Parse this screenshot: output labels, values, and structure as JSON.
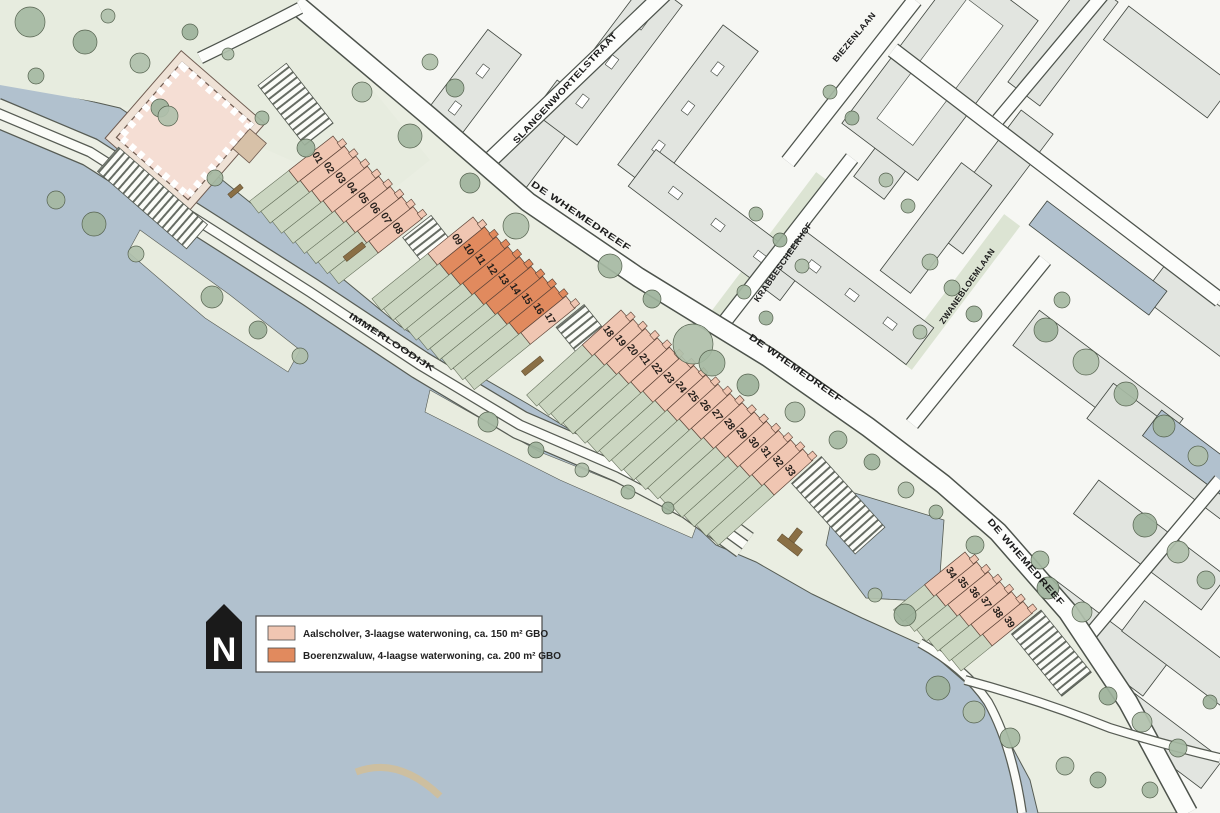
{
  "streets": {
    "slangenwortelstraat": "SLANGENWORTELSTRAAT",
    "de_whemedreef": "DE WHEMEDREEF",
    "immerloodijk": "IMMERLOODIJK",
    "biezenlaan": "BIEZENLAAN",
    "krabbescheerhof": "KRABBESCHEERHOF",
    "zwanebloemlaan": "ZWANEBLOEMLAAN"
  },
  "legend": {
    "items": [
      {
        "key": "aalscholver",
        "color": "#f0c6b2",
        "label": "Aalscholver, 3-laagse waterwoning, ca. 150 m² GBO"
      },
      {
        "key": "boerenzwaluw",
        "color": "#e18a5e",
        "label": "Boerenzwaluw, 4-laagse waterwoning, ca. 200 m² GBO"
      }
    ]
  },
  "compass": {
    "label": "N"
  },
  "plot_types": {
    "aalscholver": "#f0c6b2",
    "boerenzwaluw": "#e18a5e"
  },
  "plots": [
    {
      "number": "01",
      "type": "aalscholver"
    },
    {
      "number": "02",
      "type": "aalscholver"
    },
    {
      "number": "03",
      "type": "aalscholver"
    },
    {
      "number": "04",
      "type": "aalscholver"
    },
    {
      "number": "05",
      "type": "aalscholver"
    },
    {
      "number": "06",
      "type": "aalscholver"
    },
    {
      "number": "07",
      "type": "aalscholver"
    },
    {
      "number": "08",
      "type": "aalscholver"
    },
    {
      "number": "09",
      "type": "aalscholver"
    },
    {
      "number": "10",
      "type": "boerenzwaluw"
    },
    {
      "number": "11",
      "type": "boerenzwaluw"
    },
    {
      "number": "12",
      "type": "boerenzwaluw"
    },
    {
      "number": "13",
      "type": "boerenzwaluw"
    },
    {
      "number": "14",
      "type": "boerenzwaluw"
    },
    {
      "number": "15",
      "type": "boerenzwaluw"
    },
    {
      "number": "16",
      "type": "boerenzwaluw"
    },
    {
      "number": "17",
      "type": "aalscholver"
    },
    {
      "number": "18",
      "type": "aalscholver"
    },
    {
      "number": "19",
      "type": "aalscholver"
    },
    {
      "number": "20",
      "type": "aalscholver"
    },
    {
      "number": "21",
      "type": "aalscholver"
    },
    {
      "number": "22",
      "type": "aalscholver"
    },
    {
      "number": "23",
      "type": "aalscholver"
    },
    {
      "number": "24",
      "type": "aalscholver"
    },
    {
      "number": "25",
      "type": "aalscholver"
    },
    {
      "number": "26",
      "type": "aalscholver"
    },
    {
      "number": "27",
      "type": "aalscholver"
    },
    {
      "number": "28",
      "type": "aalscholver"
    },
    {
      "number": "29",
      "type": "aalscholver"
    },
    {
      "number": "30",
      "type": "aalscholver"
    },
    {
      "number": "31",
      "type": "aalscholver"
    },
    {
      "number": "32",
      "type": "aalscholver"
    },
    {
      "number": "33",
      "type": "aalscholver"
    },
    {
      "number": "34",
      "type": "aalscholver"
    },
    {
      "number": "35",
      "type": "aalscholver"
    },
    {
      "number": "36",
      "type": "aalscholver"
    },
    {
      "number": "37",
      "type": "aalscholver"
    },
    {
      "number": "38",
      "type": "aalscholver"
    },
    {
      "number": "39",
      "type": "aalscholver"
    }
  ]
}
